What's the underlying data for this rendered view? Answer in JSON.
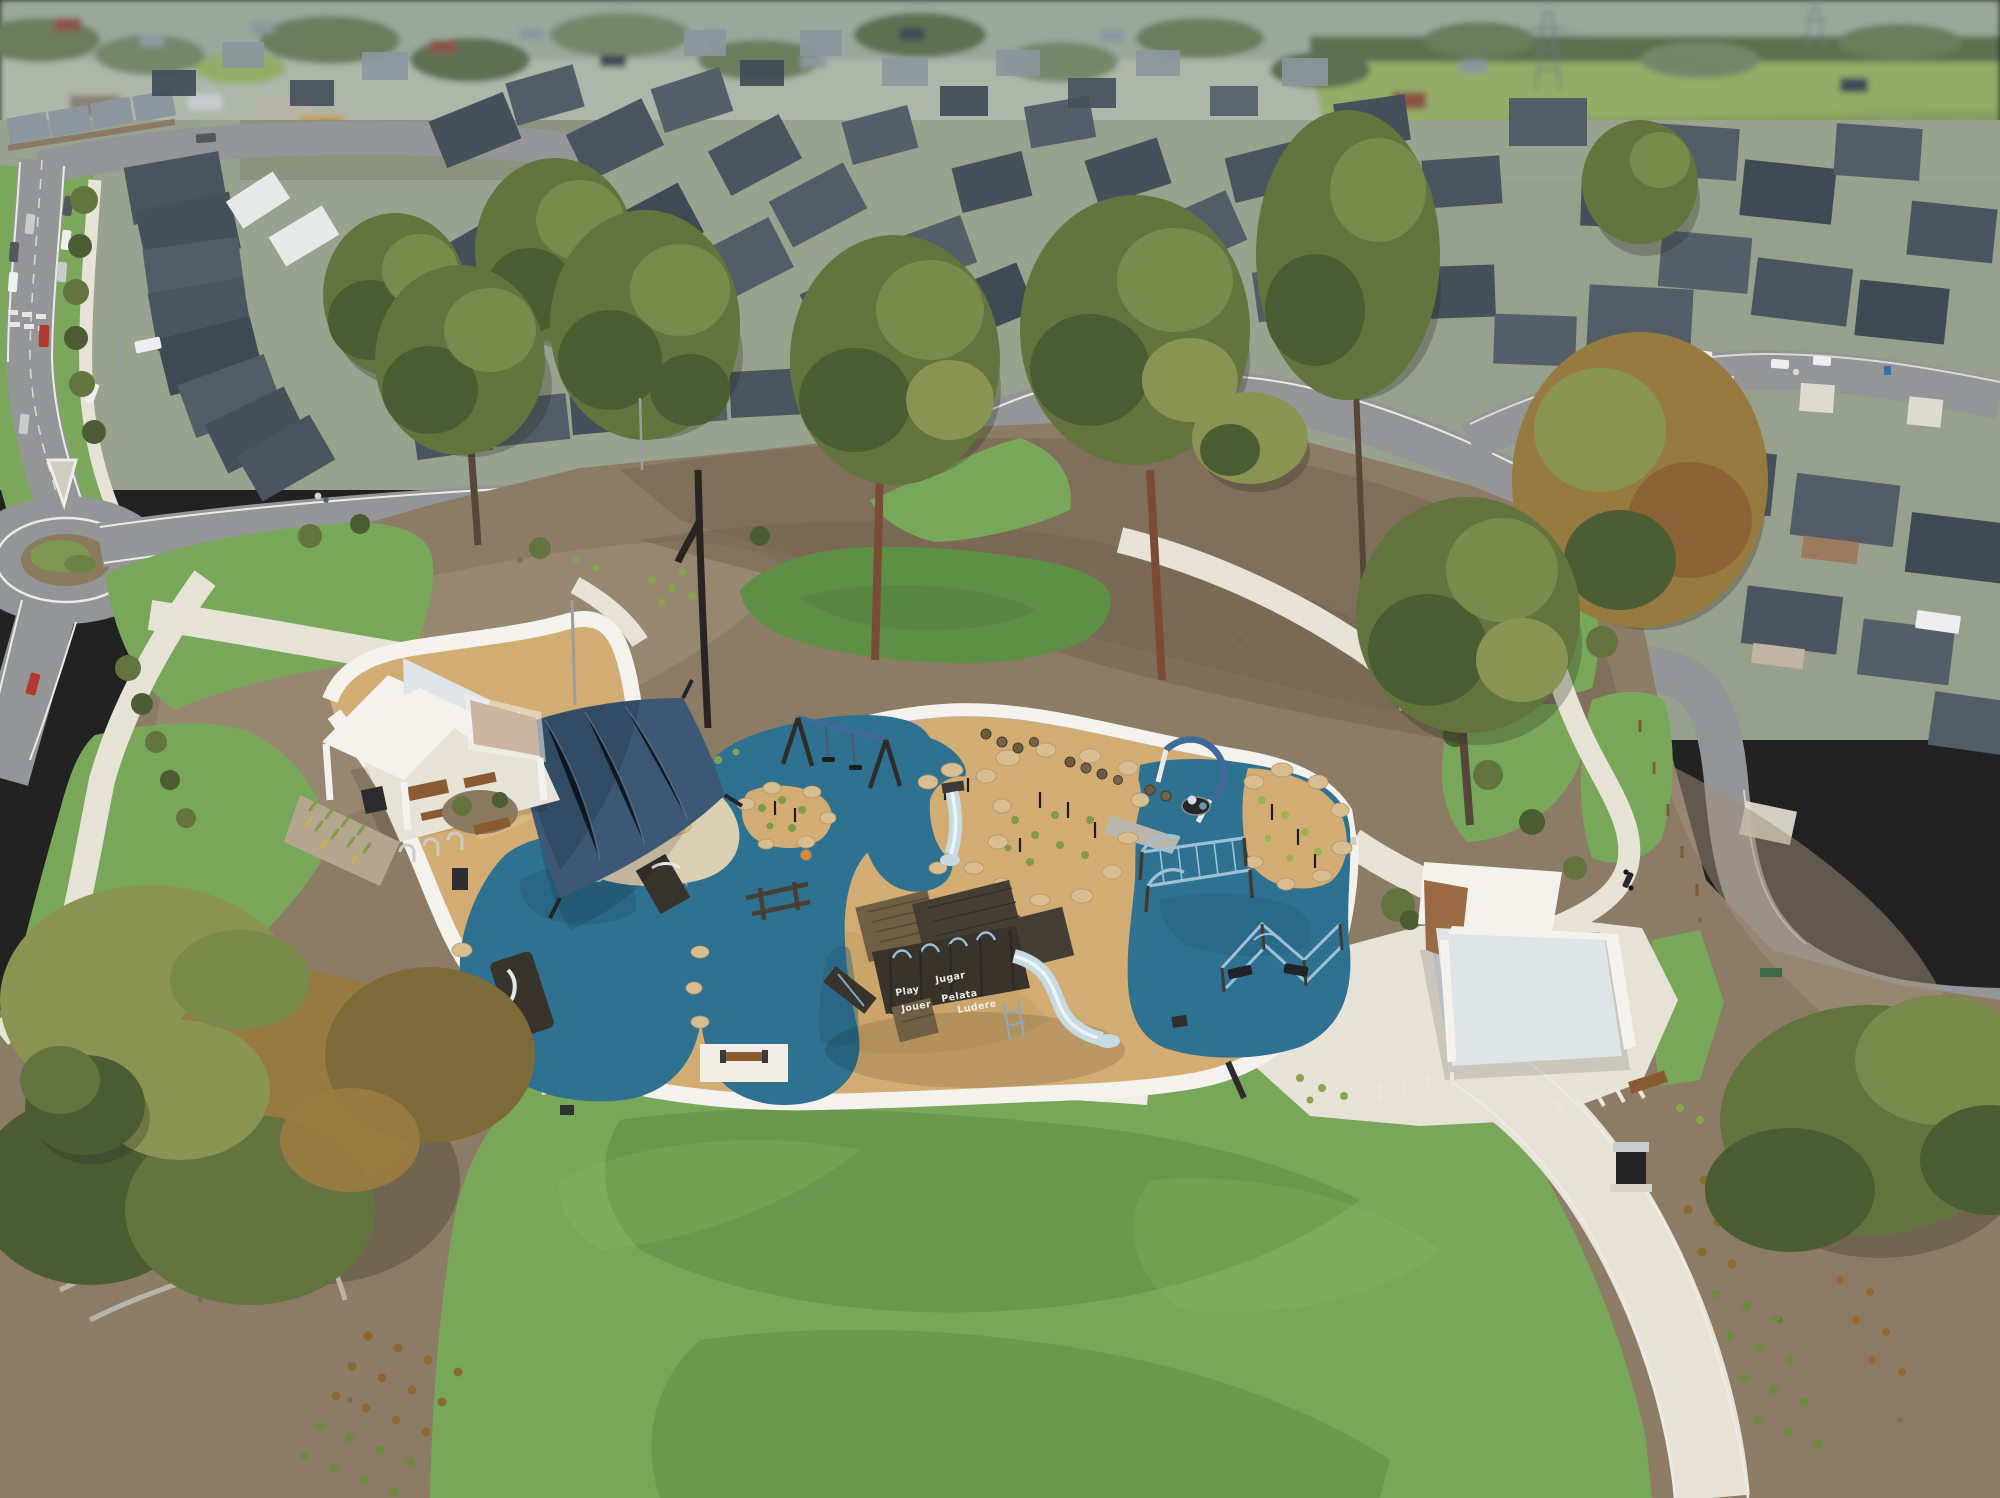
{
  "meta": {
    "title": "Aerial view — new suburban estate park with nature-play playground"
  },
  "labels": {
    "scene": "Aerial drone photo of a residential estate park",
    "distant_suburb": "distant established suburb and fields",
    "suburb": "new estate houses with charcoal roofs",
    "roads": "estate streets",
    "roundabout": "roundabout with planted island",
    "park": "park mulch and lawns",
    "playground": "nature-play playground with blue rubber and woodchip surfacing",
    "shade_sail": "blue shade sail",
    "sandpit": "sand and rock water-play area",
    "fort": "timber play fort with slide",
    "swings": "swing set",
    "basket_swing": "basket swing with parent and child",
    "mound_slide": "small slide on rock mound",
    "monkey_bars": "steel climbing frame",
    "climber": "steel balance climber",
    "left_shelter": "white park shelter with picnic tables and BBQ",
    "right_shelter": "white park shelter with picnic tables and BBQ",
    "bottom_lawn": "open kickabout lawn",
    "bench": "park bench",
    "bin": "litter bin",
    "garden_beds": "new garden beds with tube-stock planting",
    "trees": "retained eucalyptus trees",
    "vehicles": "parked cars",
    "motorbike": "parked motorbike",
    "people": "people in the park",
    "pylon": "transmission tower"
  },
  "playground": {
    "fort_words": [
      "Play",
      "Jugar",
      "Pelata",
      "Jouer",
      "Ludere"
    ]
  },
  "colors": {
    "haze": "#adb6a8",
    "field": "#93ad68",
    "field_dark": "#7e9a58",
    "road": "#939596",
    "road_dark": "#85878a",
    "line_white": "#eceae4",
    "path": "#e6e2d6",
    "path_bright": "#f0ede4",
    "lawn": "#79a75a",
    "lawn_dark": "#5d8f44",
    "lawn_deep": "#4f7f3a",
    "mulch": "#8c7c66",
    "mulch_dark": "#74644f",
    "mulch_light": "#a1907a",
    "chip": "#d2ac72",
    "chip_dark": "#c0985c",
    "chip_light": "#e0c189",
    "rubber": "#2e7190",
    "rubber_dark": "#255e7a",
    "sand": "#dbcfb2",
    "rock": "#d7bd90",
    "rock_dark": "#b1966a",
    "white_struct": "#f3f2ed",
    "white_shade": "#dfe4e6",
    "sail": "#3c5875",
    "sail_dark": "#314a63",
    "roof_a": "#4a5560",
    "roof_b": "#525d68",
    "roof_c": "#45505b",
    "roof_d": "#555f6a",
    "roof_e": "#3f4a55",
    "roof_light": "#8d969e",
    "roof_white": "#e7e9e9",
    "roof_red": "#8a5446",
    "wall_brick": "#9b7a5d",
    "wall_render": "#bfb4a4",
    "tree": "#63743f",
    "tree_dark": "#4c5c33",
    "tree_light": "#798a4b",
    "tree_olive": "#8a9452",
    "tree_rust": "#967a40",
    "trunk": "#564739",
    "trunk_red": "#7a4b36",
    "trunk_burnt": "#2a2521",
    "steel": "#9dc0d5",
    "steel_dark": "#3f6a9a",
    "fort": "#38332b",
    "fort_wood": "#6f5f45",
    "fort_deck": "#443e34",
    "slide": "#c6dae2",
    "timber": "#8a5a33",
    "car_white": "#eeeeee",
    "car_silver": "#c9cbcd",
    "car_dark": "#54585c",
    "car_red": "#b03a32",
    "text_white": "#efeee6"
  }
}
